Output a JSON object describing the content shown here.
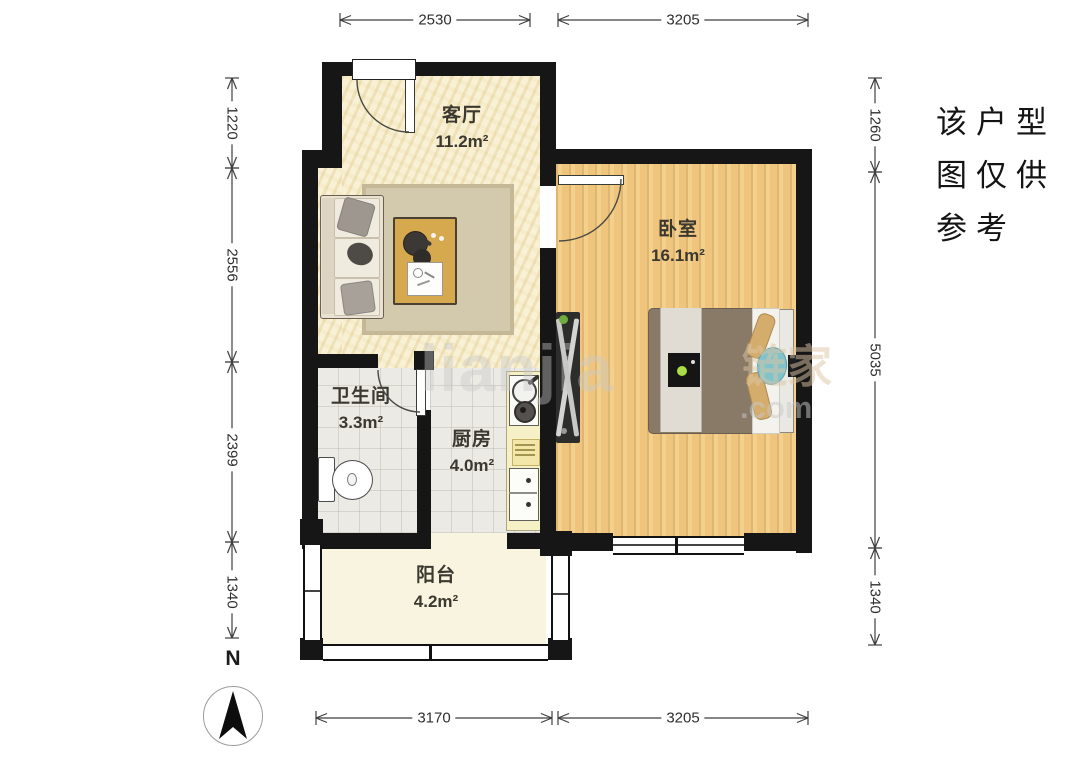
{
  "rooms": [
    {
      "name": "客厅",
      "area": "11.2m²"
    },
    {
      "name": "卧室",
      "area": "16.1m²"
    },
    {
      "name": "卫生间",
      "area": "3.3m²"
    },
    {
      "name": "厨房",
      "area": "4.0m²"
    },
    {
      "name": "阳台",
      "area": "4.2m²"
    }
  ],
  "dimensions": {
    "top": [
      "2530",
      "3205"
    ],
    "bottom": [
      "3170",
      "3205"
    ],
    "left": [
      "1220",
      "2556",
      "2399",
      "1340"
    ],
    "right": [
      "1260",
      "5035",
      "1340"
    ]
  },
  "note_lines": [
    "该户型",
    "图仅供",
    "参考"
  ],
  "compass_label": "N",
  "watermark": {
    "latin": "lianjia",
    "cjk": "链家",
    "tld": ".com"
  },
  "colors": {
    "wall": "#161616",
    "living_floor": "#f4ebc9",
    "bedroom_floor": "#efc57e",
    "tile_floor": "#ebeae5",
    "balcony_floor": "#f8f4df",
    "dimension_text": "#2f2f2f"
  }
}
